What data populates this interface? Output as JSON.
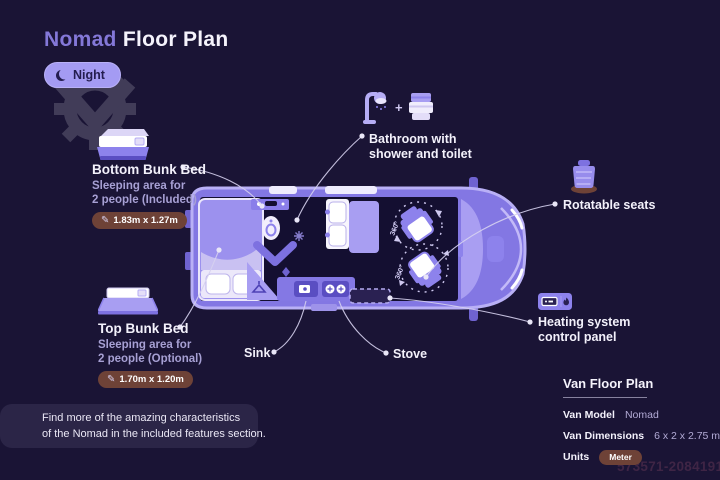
{
  "header": {
    "title_accent": "Nomad",
    "title_rest": "Floor Plan",
    "mode_label": "Night"
  },
  "callouts": {
    "bottom_bunk": {
      "title": "Bottom Bunk Bed",
      "desc1": "Sleeping area for",
      "desc2": "2 people (Included)",
      "dimensions": "1.83m x 1.27m",
      "pencil_icon": "✎"
    },
    "top_bunk": {
      "title": "Top Bunk Bed",
      "desc1": "Sleeping area for",
      "desc2": "2 people (Optional)",
      "dimensions": "1.70m x 1.20m",
      "pencil_icon": "✎"
    },
    "bathroom": {
      "plus": "+",
      "label1": "Bathroom with",
      "label2": "shower and toilet"
    },
    "rotatable_seats": {
      "label": "Rotatable seats"
    },
    "heating": {
      "label1": "Heating system",
      "label2": "control panel"
    },
    "sink": {
      "label": "Sink"
    },
    "stove": {
      "label": "Stove"
    }
  },
  "van": {
    "rotation_label_front": "360°",
    "rotation_label_rear": "360°"
  },
  "note": {
    "line1": "Find more of the amazing characteristics",
    "line2": "of the Nomad in the included features section."
  },
  "spec_table": {
    "title": "Van Floor Plan",
    "rows": [
      {
        "label": "Van Model",
        "value": "Nomad"
      },
      {
        "label": "Van Dimensions",
        "value": "6 x 2 x 2.75 m"
      },
      {
        "label": "Units",
        "value": "Meter"
      }
    ]
  },
  "watermark_id": "573571-20841915",
  "colors": {
    "background": "#1a1435",
    "accent_purple": "#8478d8",
    "van_body": "#8377e3",
    "van_trim": "#b9b0f6",
    "van_interior": "#140f31",
    "badge_brown": "#6e4237",
    "night_pill": "#a49bf3",
    "leader_line": "#d6d1ef"
  }
}
